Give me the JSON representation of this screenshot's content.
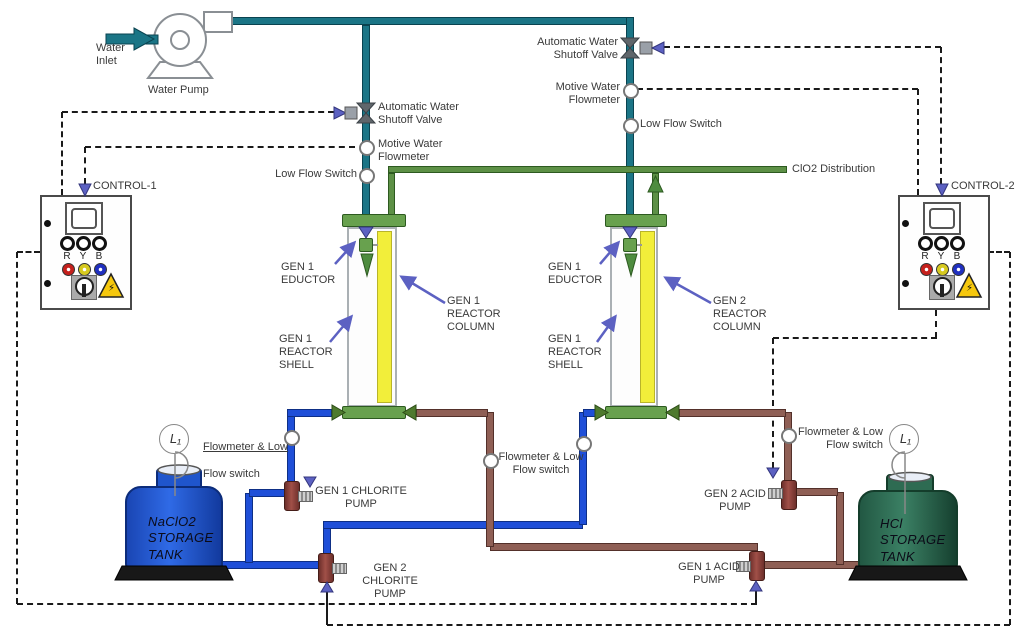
{
  "water": {
    "inlet": "Water\nInlet",
    "pump": "Water Pump"
  },
  "instruments": {
    "auto_shutoff_valve": "Automatic Water\nShutoff Valve",
    "motive_flowmeter": "Motive Water\nFlowmeter",
    "low_flow_switch": "Low Flow Switch",
    "flow_low_line1": "Flowmeter & Low",
    "flow_low_line2": "Flow switch",
    "flow_low": "Flowmeter & Low\nFlow switch"
  },
  "control_panels": {
    "panel1": "CONTROL-1",
    "panel2": "CONTROL-2",
    "lamp_r": "R",
    "lamp_y": "Y",
    "lamp_b": "B",
    "hazard_symbol": "⚡"
  },
  "distribution_label": "ClO2 Distribution",
  "reactor_labels": {
    "gen1_eductor": "GEN 1\nEDUCTOR",
    "gen1_shell": "GEN 1\nREACTOR\nSHELL",
    "gen1_column": "GEN 1\nREACTOR\nCOLUMN",
    "gen2_eductor": "GEN 1\nEDUCTOR",
    "gen2_shell": "GEN 1\nREACTOR\nSHELL",
    "gen2_column": "GEN 2\nREACTOR\nCOLUMN"
  },
  "pump_labels": {
    "gen1_chlorite": "GEN 1 CHLORITE\nPUMP",
    "gen2_chlorite": "GEN 2 CHLORITE\nPUMP",
    "gen1_acid": "GEN 1 ACID\nPUMP",
    "gen2_acid": "GEN 2 ACID\nPUMP"
  },
  "tanks": {
    "chlorite": "NaClO2\nSTORAGE\nTANK",
    "acid": "HCl\nSTORAGE\nTANK",
    "level_indicator": "L₁"
  },
  "colors": {
    "water_pipe": "#1b7586",
    "clo2_pipe": "#5d9046",
    "chlorite_pipe": "#1f4fd8",
    "acid_pipe": "#8f5f55",
    "control_line": "#1a1a1a",
    "actuator_arrow": "#5c61c2",
    "chlorite_tank": "#1f55cc",
    "acid_tank": "#2e6b52",
    "reactor_column": "#f2ee3a",
    "hardware_green": "#68a14e"
  }
}
